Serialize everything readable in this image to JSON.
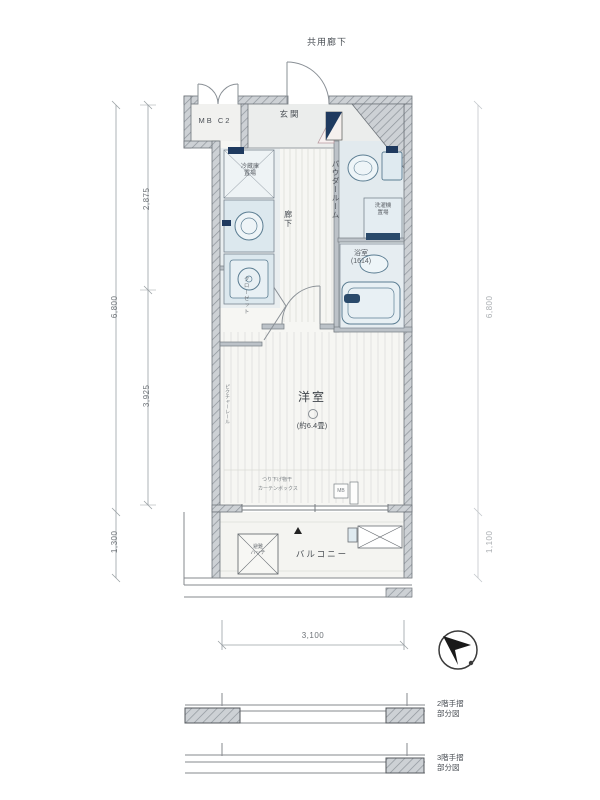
{
  "labels": {
    "common_corridor": "共用廊下",
    "meter_box": "MB C2",
    "entrance": "玄関",
    "refrigerator_l1": "冷蔵庫",
    "refrigerator_l2": "置場",
    "hallway": "廊下",
    "powder_room": "パウダールーム",
    "washer_l1": "洗濯機",
    "washer_l2": "置場",
    "bathroom": "浴室",
    "bathroom_size": "(1614)",
    "western_room": "洋室",
    "western_room_size": "(約6.4畳)",
    "closet": "クローゼット",
    "picture_rail": "ピクチャーレール",
    "laundry_hook": "つり下げ物干",
    "curtain_box": "カーテンボックス",
    "mb_small": "MB",
    "balcony": "バルコニー",
    "escape_hatch_l1": "避難",
    "escape_hatch_l2": "ハッチ"
  },
  "dimensions": {
    "left_upper": "2,875",
    "left_lower": "3,925",
    "left_total": "6,800",
    "left_balcony": "1,300",
    "right_total": "6,800",
    "right_balcony": "1,100",
    "bottom_width": "3,100"
  },
  "partial_plans": {
    "floor2_l1": "2階手摺",
    "floor2_l2": "部分図",
    "floor3_l1": "3階手摺",
    "floor3_l2": "部分図"
  },
  "colors": {
    "wall_fill": "#cdd1d5",
    "wall_hatch": "#8d939a",
    "wet_area": "#e2eaee",
    "fixture_stroke": "#5b7d92",
    "accent_navy": "#1f3a5f"
  }
}
